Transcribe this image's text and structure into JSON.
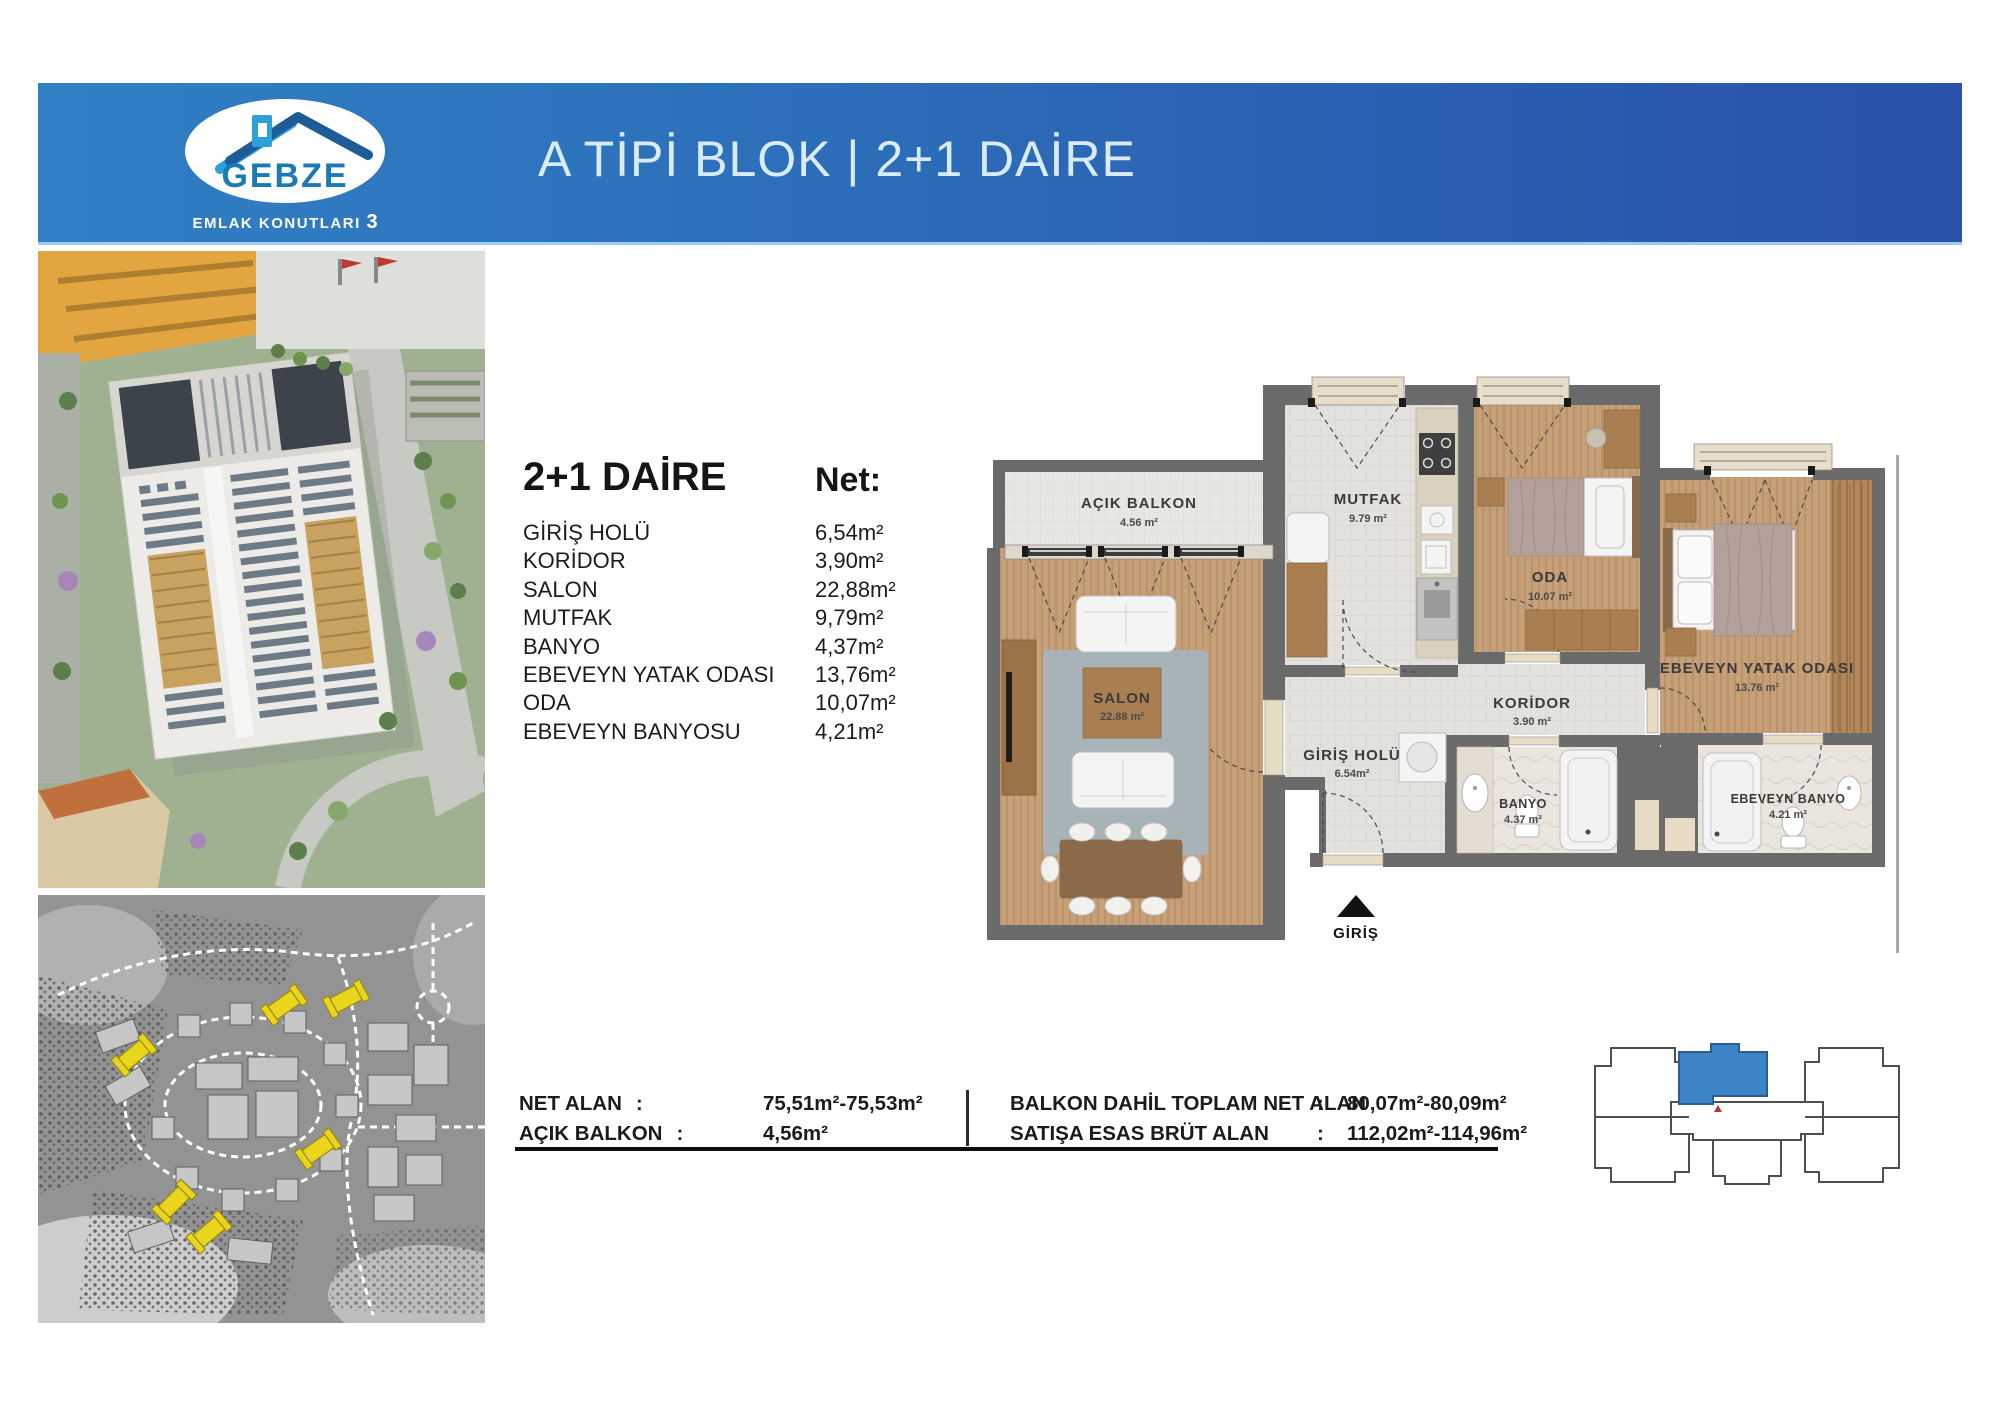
{
  "header": {
    "logo": {
      "brand": "GEBZE",
      "subtitle": "EMLAK KONUTLARI",
      "subtitle_number": "3"
    },
    "title": "A TİPİ BLOK | 2+1 DAİRE"
  },
  "unit_summary": {
    "title": "2+1 DAİRE",
    "net_label": "Net:",
    "rooms": [
      {
        "name": "GİRİŞ HOLÜ",
        "area": "6,54m²"
      },
      {
        "name": "KORİDOR",
        "area": "3,90m²"
      },
      {
        "name": "SALON",
        "area": "22,88m²"
      },
      {
        "name": "MUTFAK",
        "area": "9,79m²"
      },
      {
        "name": "BANYO",
        "area": "4,37m²"
      },
      {
        "name": "EBEVEYN YATAK ODASI",
        "area": "13,76m²"
      },
      {
        "name": "ODA",
        "area": "10,07m²"
      },
      {
        "name": "EBEVEYN BANYOSU",
        "area": "4,21m²"
      }
    ]
  },
  "floor_plan": {
    "rooms": {
      "acik_balkon": {
        "name": "AÇIK BALKON",
        "area": "4.56 m²"
      },
      "mutfak": {
        "name": "MUTFAK",
        "area": "9.79 m²"
      },
      "oda": {
        "name": "ODA",
        "area": "10.07 m²"
      },
      "ebeveyn_yatak_odasi": {
        "name": "EBEVEYN YATAK ODASI",
        "area": "13.76 m²"
      },
      "salon": {
        "name": "SALON",
        "area": "22.88 m²"
      },
      "koridor": {
        "name": "KORİDOR",
        "area": "3.90 m²"
      },
      "giris_holu": {
        "name": "GİRİŞ HOLÜ",
        "area": "6.54m²"
      },
      "banyo": {
        "name": "BANYO",
        "area": "4.37 m²"
      },
      "ebeveyn_banyo": {
        "name": "EBEVEYN BANYO",
        "area": "4.21 m²"
      }
    },
    "entrance_label": "GİRİŞ"
  },
  "area_summary": {
    "left": [
      {
        "label": "NET ALAN",
        "sep": ":",
        "value": "75,51m²-75,53m²"
      },
      {
        "label": "AÇIK BALKON",
        "sep": ":",
        "value": "4,56m²"
      }
    ],
    "right": [
      {
        "label": "BALKON DAHİL TOPLAM NET ALAN",
        "sep": ":",
        "value": "80,07m²-80,09m²"
      },
      {
        "label": "SATIŞA ESAS BRÜT ALAN",
        "sep": ":",
        "value": "112,02m²-114,96m²"
      }
    ]
  },
  "colors": {
    "header_blue_left": "#3180c5",
    "header_blue_right": "#2a52a9",
    "unit_highlight_blue": "#3d84c6",
    "siteplan_highlight_yellow": "#e9d51c",
    "wall_gray": "#6a6a6a"
  }
}
